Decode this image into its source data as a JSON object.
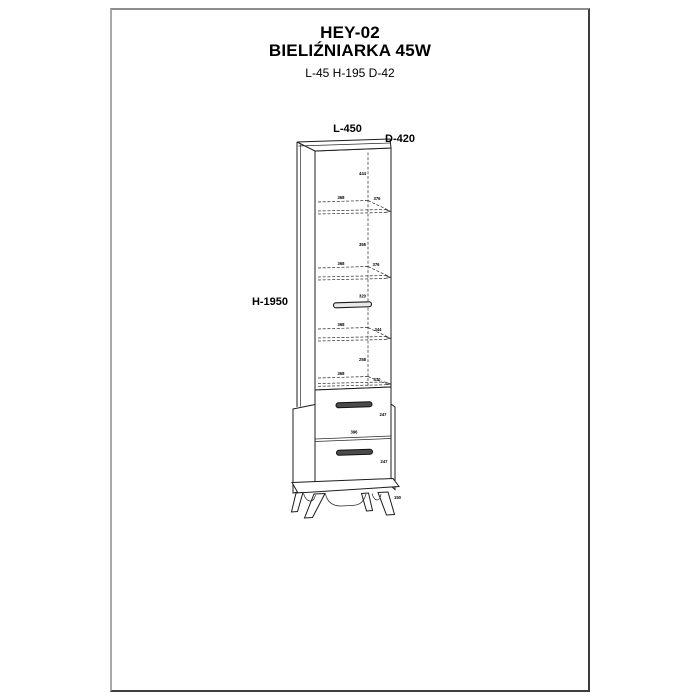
{
  "header": {
    "model": "HEY-02",
    "product_name": "BIELIŹNIARKA 45W",
    "overall_dimensions": "L-45 H-195 D-42"
  },
  "diagram": {
    "width_label": "L-450",
    "depth_label": "D-420",
    "height_label": "H-1950",
    "top_section_height": "444",
    "shelf1_width": "368",
    "shelf1_depth": "376",
    "gap1": "355",
    "shelf2_width": "368",
    "shelf2_depth": "376",
    "gap2": "320",
    "shelf3_width": "368",
    "shelf3_depth": "344",
    "gap3": "258",
    "shelf4_width": "368",
    "shelf4_depth": "470",
    "drawer1_height": "247",
    "drawer1_width": "396",
    "drawer2_height": "247",
    "drawer2_width": "396",
    "leg_height": "150"
  }
}
